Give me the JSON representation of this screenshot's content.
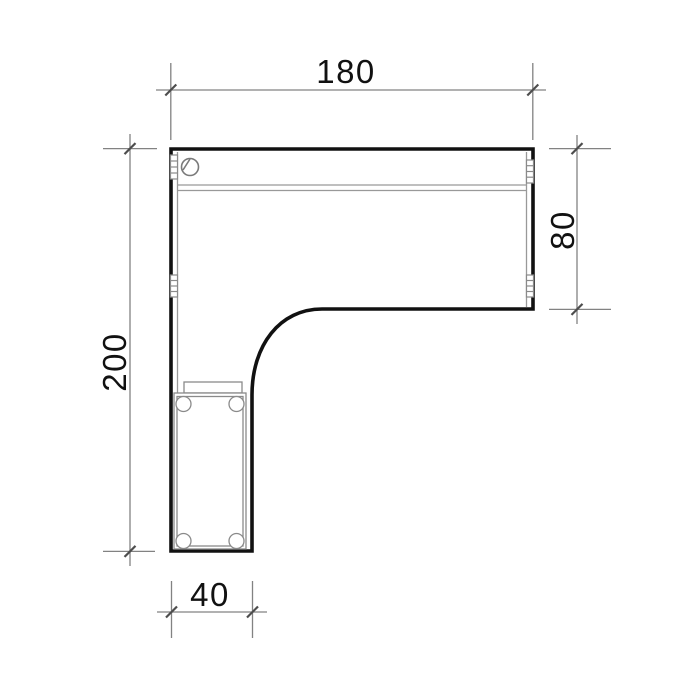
{
  "drawing": {
    "type": "furniture-plan-diagram",
    "subject": "l-shaped-desk-top-view",
    "dimensions": {
      "top": "180",
      "right": "80",
      "left": "200",
      "bottom": "40"
    },
    "colors": {
      "background": "#ffffff",
      "outline": "#111111",
      "detail_lines": "#999999",
      "dimension_lines": "#828282",
      "tick_marks": "#4d4d4d",
      "text": "#111111"
    }
  }
}
